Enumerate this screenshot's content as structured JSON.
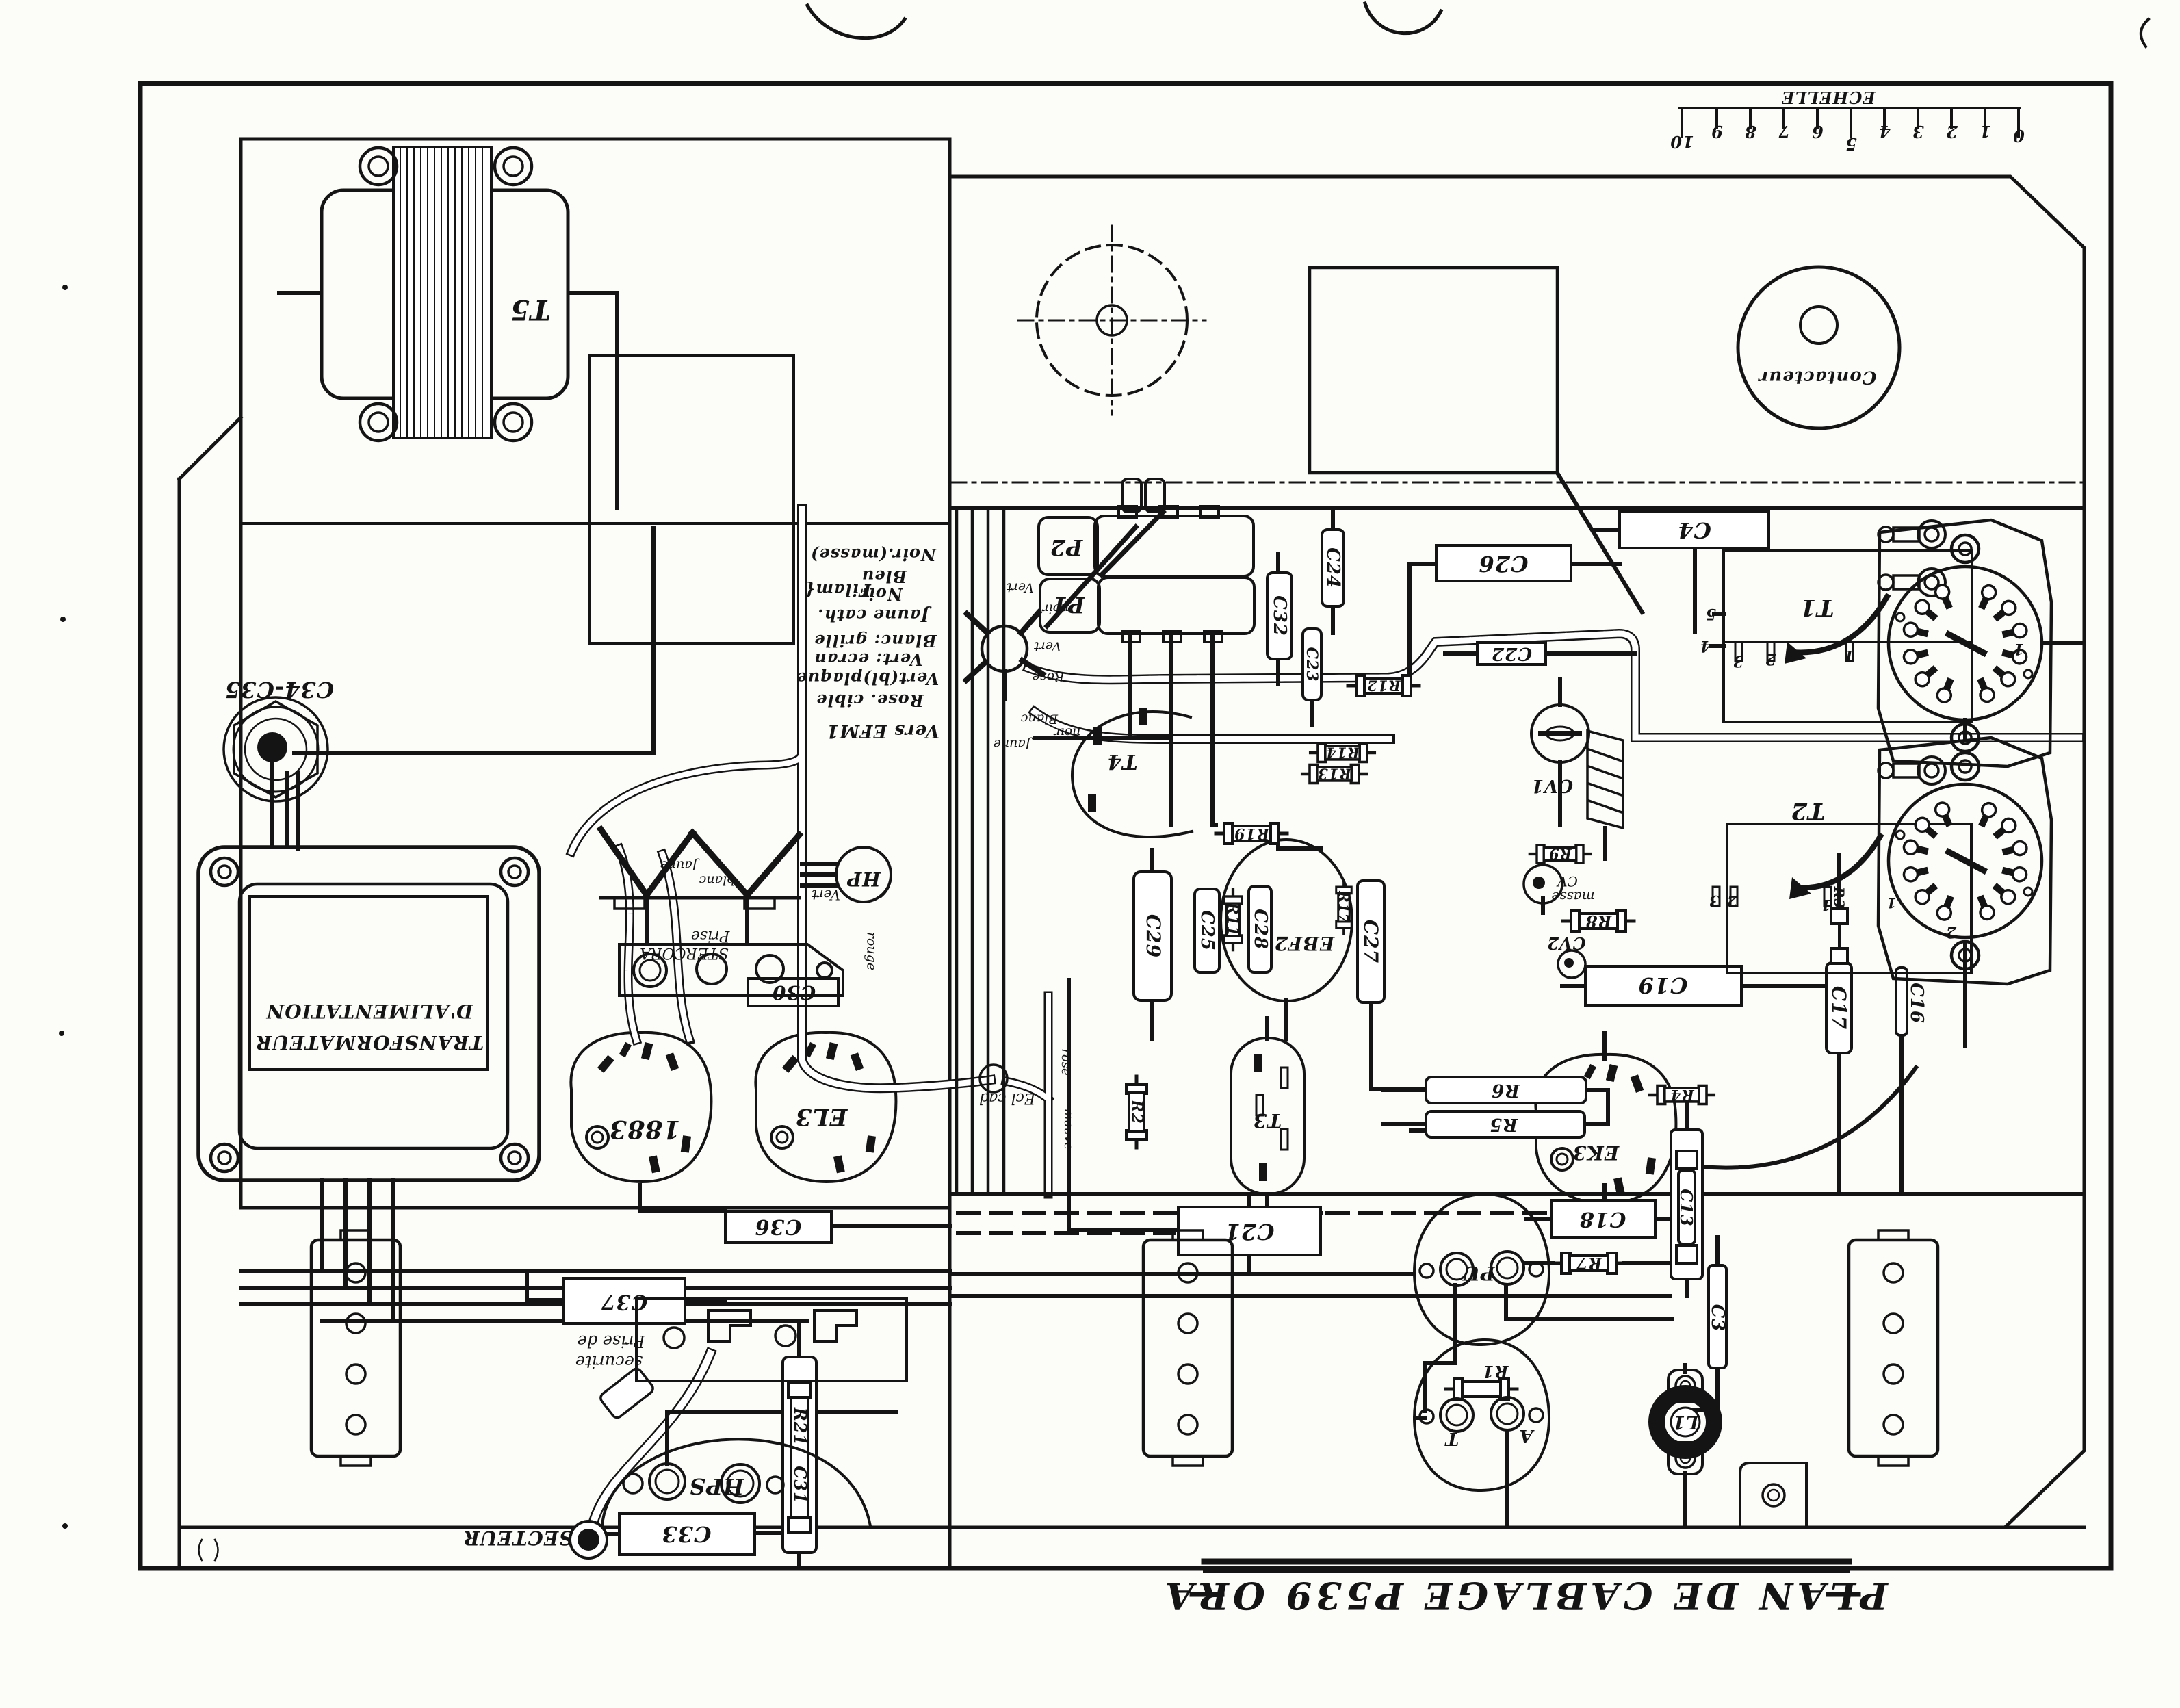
{
  "document": {
    "kind": "scanned wiring diagram, printed upside-down (rotated 180°)",
    "title": "PLAN DE CABLAGE  P539  ORA",
    "ink_color": "#141414",
    "paper_color": "#fcfcf9"
  },
  "scale": {
    "label": "ECHELLE",
    "ticks": [
      "0",
      "1",
      "2",
      "3",
      "4",
      "5",
      "6",
      "7",
      "8",
      "9",
      "10"
    ]
  },
  "legend": {
    "lines": [
      "Vers EFM1",
      "Rose. cible",
      "Vert(bl)plaque",
      "Vert: ecran",
      "Blanc: grille",
      "Jaune cath.",
      "Noir / Bleu { Filam",
      "Noir.(masse)"
    ]
  },
  "labels": {
    "title": "PLAN DE CABLAGE  P539 ORA",
    "echelle": "ECHELLE",
    "s0": "0",
    "s1": "1",
    "s2": "2",
    "s3": "3",
    "s4": "4",
    "s5": "5",
    "s6": "6",
    "s7": "7",
    "s8": "8",
    "s9": "9",
    "s10": "10",
    "t5": "T5",
    "c34": "C34-C35",
    "tr1": "D'ALIMENTATION",
    "tr2": "TRANSFORMATEUR",
    "leg_masse": "Noir.(masse)",
    "leg_bleu": "Bleu",
    "leg_noir": "Noir",
    "leg_filam": "Filam{",
    "leg_jaune": "Jaune cath.",
    "leg_blanc": "Blanc: grille",
    "leg_vert2": "Vert: ecran",
    "leg_vertbl": "Vert(bl)plaque",
    "leg_rose": "Rose. cible",
    "leg_vers": "Vers EFM1",
    "v1883": "1883",
    "el3": "EL3",
    "c36": "C36",
    "c37": "C37",
    "psec1": "Prise de",
    "psec2": "securite",
    "hps": "HPS",
    "c33": "C33",
    "secteur": "SECTEUR",
    "r21": "R21",
    "c31": "C31",
    "pst1": "Prise",
    "pst2": "STERCORA",
    "c30": "C30",
    "hp": "HP",
    "vert_hp": "Vert",
    "jaune1": "Jaune",
    "blanc1": "blanc",
    "rouge1": "rouge",
    "ecl": "Ecl cad",
    "rose2": "rose",
    "mauve1": "mauve",
    "vert_a": "Vert",
    "noir_a": "noir",
    "vert_b": "Vert",
    "rose_a": "Rose",
    "blanc_a": "Blanc",
    "noir_b": "noir",
    "jaune_a": "Jaune",
    "t4": "T4",
    "p2": "P2",
    "p1": "P1",
    "r19": "R19",
    "r12": "R12",
    "r14": "R14",
    "r13": "R13",
    "c22": "C22",
    "c26": "C26",
    "c4": "C4",
    "c32": "C32",
    "c23": "C23",
    "c24": "C24",
    "c29": "C29",
    "c25": "C25",
    "r11": "R11",
    "c28": "C28",
    "ebf2": "EBF2",
    "r17": "R17",
    "c27": "C27",
    "cv1": "CV1",
    "r9": "R9",
    "cvm1": "CV",
    "cvm2": "masse",
    "r8": "R8",
    "cv2": "CV2",
    "c19": "C19",
    "r6": "R6",
    "r5": "R5",
    "r4": "R4",
    "ek3": "EK3",
    "c18": "C18",
    "r7": "R7",
    "c13": "C13",
    "r3": "R3",
    "c3": "C3",
    "c17": "C17",
    "c16": "C16",
    "c21": "C21",
    "t3": "T3",
    "r2": "R2",
    "pu": "PU",
    "r1": "R1",
    "tl": "T",
    "al": "A",
    "l1": "L1",
    "t1": "T1",
    "t2": "T2",
    "contacteur": "Contacteur",
    "p5n": "5",
    "p4n": "4",
    "p3n": "3",
    "p2n": "2",
    "p1n": "1",
    "q3": "3",
    "q2": "2",
    "q1": "1",
    "q2b": "2",
    "w1": "1",
    "w2": "1"
  }
}
